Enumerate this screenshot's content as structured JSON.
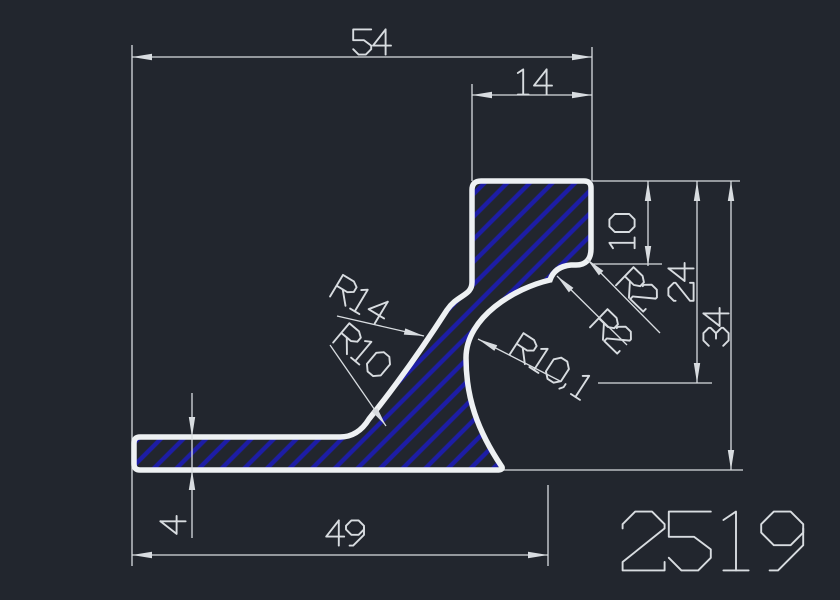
{
  "app": {
    "type": "cad-profile-drawing",
    "view": "cross-section"
  },
  "drawing": {
    "part_number": "2519",
    "dimensions": {
      "width_total": "54",
      "width_top": "14",
      "notch_depth": "10",
      "mid_height": "24",
      "total_height": "34",
      "base_thickness": "4",
      "base_length": "49"
    },
    "radii": {
      "r14": "R14",
      "r10": "R10",
      "r10_1": "R10,1",
      "r2_upper": "R2",
      "r2_lower": "R2"
    },
    "colors": {
      "background": "#22262e",
      "line": "#d8dce0",
      "outline": "#eef1f3",
      "hatch": "#1d1da6"
    }
  }
}
